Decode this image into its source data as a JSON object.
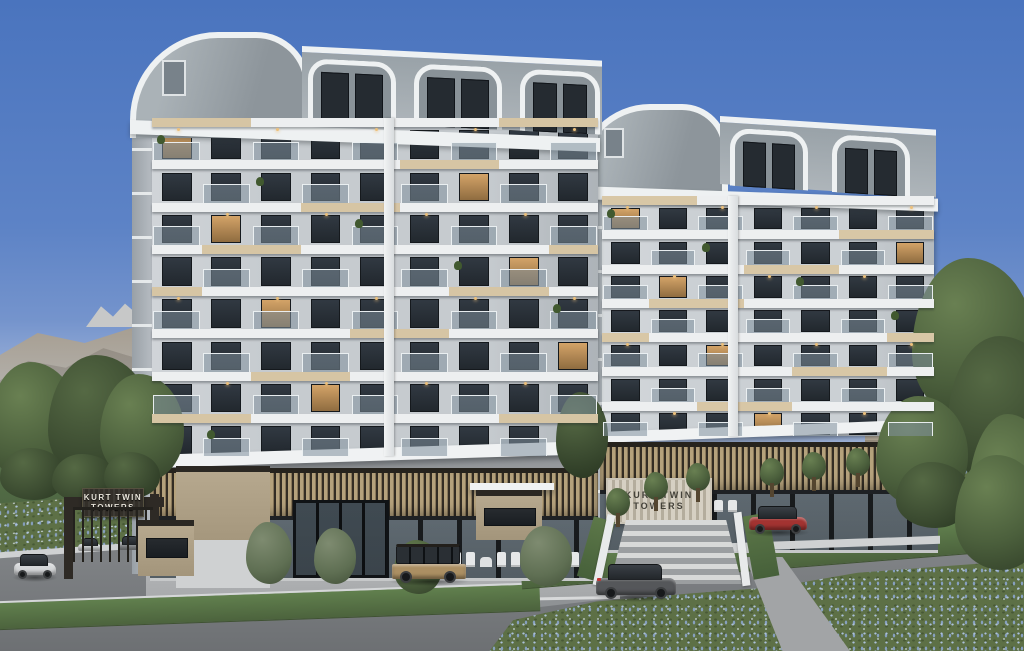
{
  "scene": {
    "description": "3D architectural exterior rendering of the Kurt Twin Towers residential complex with two curved-roof apartment blocks, mountains, city skyline, roads, cars and blue flower meadows",
    "sky": {
      "top": "#4a74be",
      "horizon": "#c9d4e6"
    },
    "palette": {
      "wall": "#c6cbcf",
      "slab_white": "#edeff0",
      "slab_beige": "#d6c5a4",
      "window_dark": "#2b323a",
      "window_lit": "#d3a368",
      "roof_gray": "#97a0a6",
      "louver_wood": "#b5a27c",
      "asphalt": "#85888b",
      "grass": "#5a7647",
      "flower_blue": "#a8bedd",
      "tree_green": "#4b5f3c",
      "mountain": "#8a8073"
    }
  },
  "signage": {
    "gate_sign": {
      "line1": "KURT TWIN",
      "line2": "TOWERS"
    },
    "plaza_sign": {
      "line1": "KURT TWIN",
      "line2": "TOWERS"
    }
  },
  "buildings": {
    "tower_a": {
      "floors": 8,
      "units_per_floor": 9,
      "wall": "#c6cbcf",
      "wall_light": "#d0d4d8",
      "wall_dark": "#adb3b8",
      "accent_slab": "#d6c5a4"
    },
    "tower_b": {
      "floors": 7,
      "units_per_floor": 7,
      "wall": "#cbd0d4",
      "wall_light": "#d5d9dc",
      "wall_dark": "#b3b9be",
      "accent_slab": "#d8c7a6"
    }
  },
  "vehicles": [
    {
      "name": "white-sedan-car",
      "color": "#d5d7d9"
    },
    {
      "name": "tan-jeep-car",
      "color": "#ab8f63"
    },
    {
      "name": "gray-suv-car",
      "color": "#55575a"
    },
    {
      "name": "red-suv-car",
      "color": "#a23331"
    },
    {
      "name": "gate-parked-car-1",
      "color": "#cdd0d2"
    },
    {
      "name": "gate-parked-car-2",
      "color": "#8d9092"
    }
  ]
}
